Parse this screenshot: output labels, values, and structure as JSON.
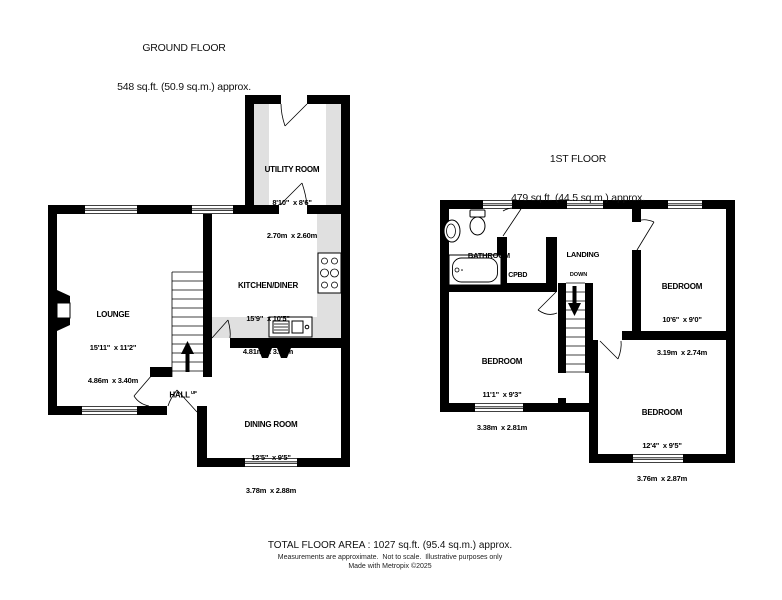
{
  "ground_floor": {
    "title": "GROUND FLOOR",
    "area": "548 sq.ft. (50.9 sq.m.) approx.",
    "rooms": {
      "lounge": {
        "name": "LOUNGE",
        "imperial": "15'11\"  x 11'2\"",
        "metric": "4.86m  x 3.40m"
      },
      "kitchen_diner": {
        "name": "KITCHEN/DINER",
        "imperial": "15'9\"  x 10'5\"",
        "metric": "4.81m  x 3.17m"
      },
      "utility_room": {
        "name": "UTILITY ROOM",
        "imperial": "8'10\"  x 8'6\"",
        "metric": "2.70m  x 2.60m"
      },
      "dining_room": {
        "name": "DINING ROOM",
        "imperial": "12'5\"  x 9'5\"",
        "metric": "3.78m  x 2.88m"
      },
      "hall": {
        "name": "HALL",
        "direction": "UP"
      }
    }
  },
  "first_floor": {
    "title": "1ST FLOOR",
    "area": "479 sq.ft. (44.5 sq.m.) approx.",
    "rooms": {
      "bathroom": {
        "name": "BATHROOM"
      },
      "cupboard": {
        "name": "CPBD"
      },
      "landing": {
        "name": "LANDING",
        "direction": "DOWN"
      },
      "bedroom_1": {
        "name": "BEDROOM",
        "imperial": "10'6\"  x 9'0\"",
        "metric": "3.19m  x 2.74m"
      },
      "bedroom_2": {
        "name": "BEDROOM",
        "imperial": "11'1\"  x 9'3\"",
        "metric": "3.38m  x 2.81m"
      },
      "bedroom_3": {
        "name": "BEDROOM",
        "imperial": "12'4\"  x 9'5\"",
        "metric": "3.76m  x 2.87m"
      }
    }
  },
  "footer": {
    "total_area": "TOTAL FLOOR AREA : 1027 sq.ft. (95.4 sq.m.) approx.",
    "disclaimer": "Measurements are approximate.  Not to scale.  Illustrative purposes only",
    "credit": "Made with Metropix ©2025"
  },
  "colors": {
    "wall": "#000000",
    "counter": "#e0e0e0",
    "background": "#ffffff"
  }
}
